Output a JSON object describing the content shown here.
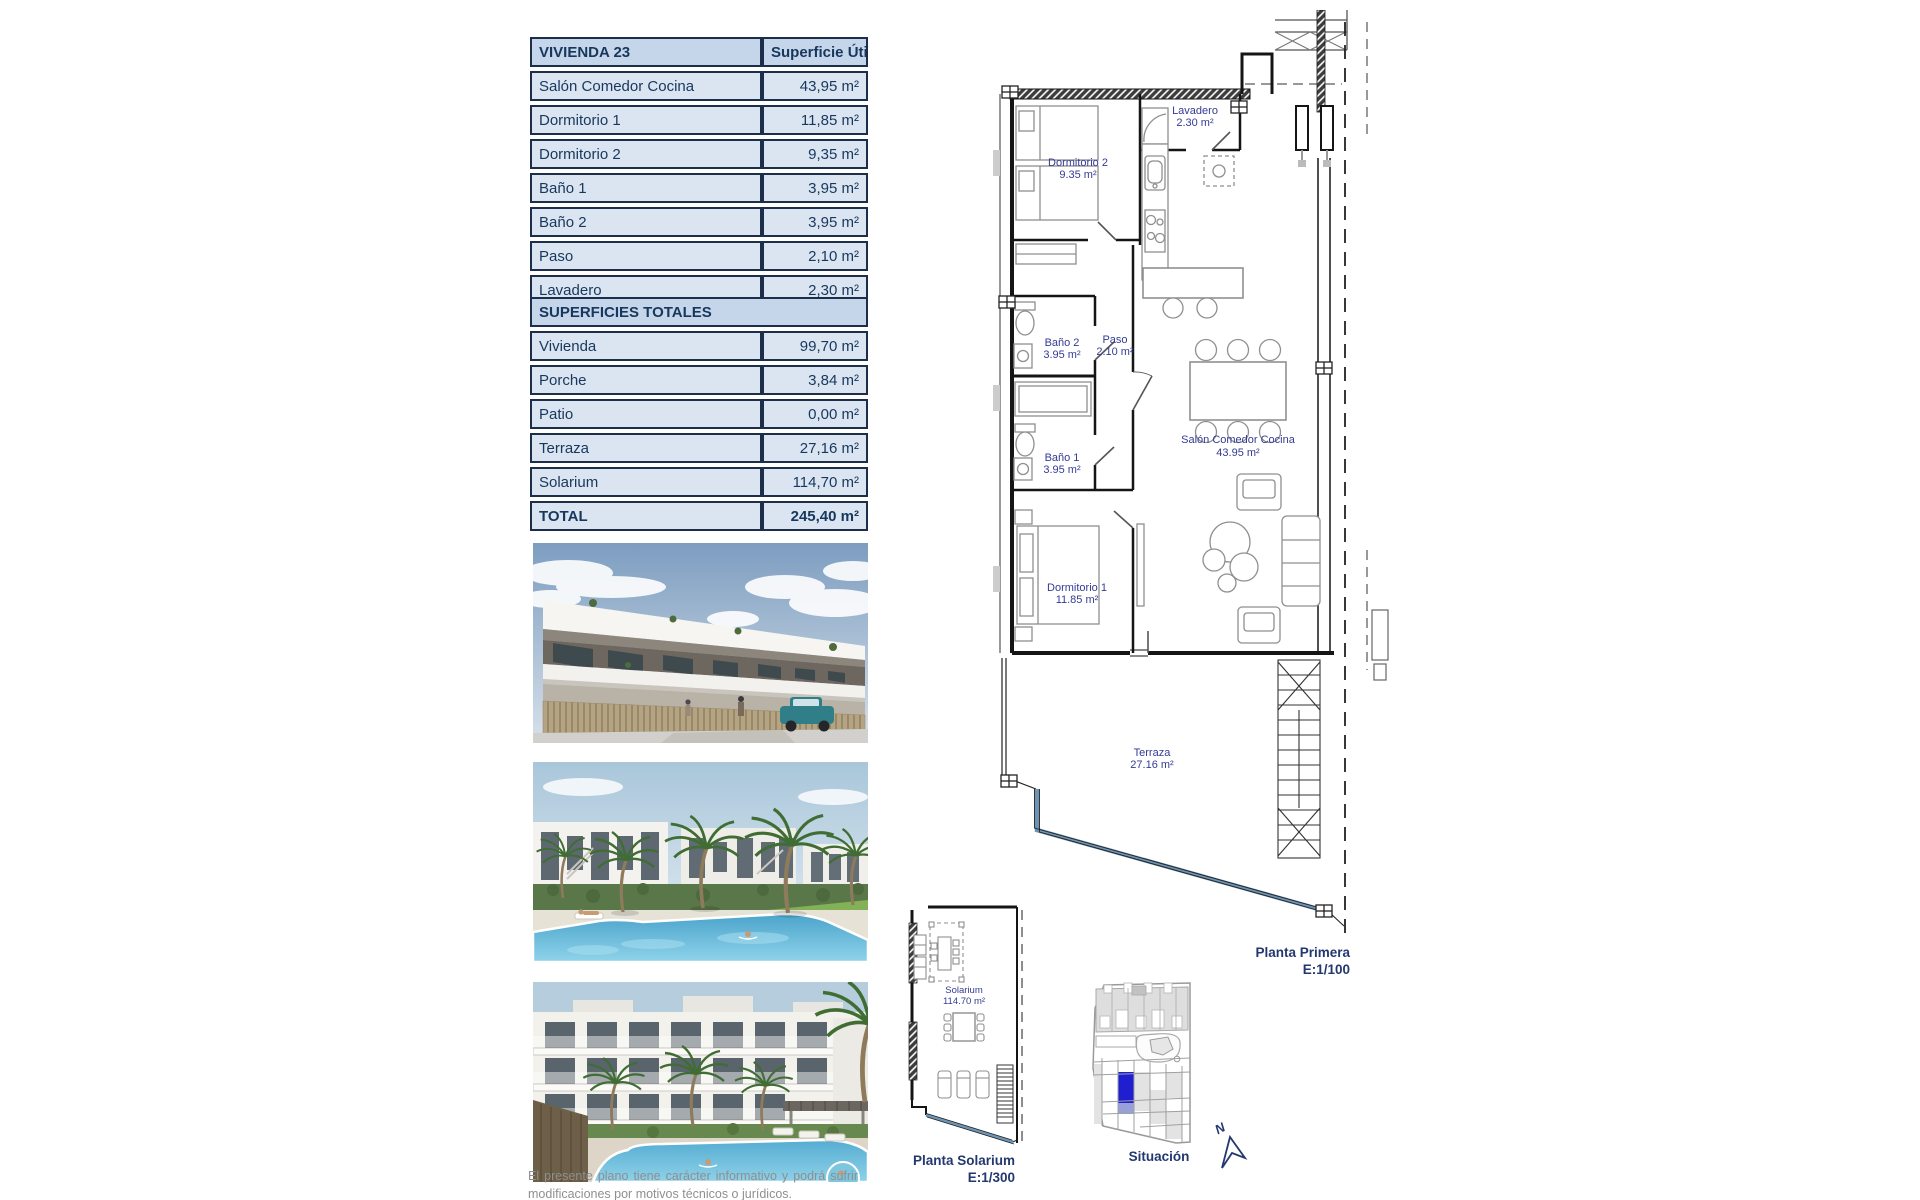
{
  "document": {
    "tables": {
      "vivienda": {
        "title": "VIVIENDA 23",
        "value_header": "Superficie Útil",
        "rows": [
          {
            "label": "Salón Comedor Cocina",
            "value": "43,95 m²"
          },
          {
            "label": "Dormitorio 1",
            "value": "11,85 m²"
          },
          {
            "label": "Dormitorio 2",
            "value": "9,35 m²"
          },
          {
            "label": "Baño 1",
            "value": "3,95 m²"
          },
          {
            "label": "Baño 2",
            "value": "3,95 m²"
          },
          {
            "label": "Paso",
            "value": "2,10 m²"
          },
          {
            "label": "Lavadero",
            "value": "2,30 m²"
          }
        ]
      },
      "totales": {
        "title": "SUPERFICIES TOTALES",
        "rows": [
          {
            "label": "Vivienda",
            "value": "99,70 m²"
          },
          {
            "label": "Porche",
            "value": "3,84 m²"
          },
          {
            "label": "Patio",
            "value": "0,00 m²"
          },
          {
            "label": "Terraza",
            "value": "27,16 m²"
          },
          {
            "label": "Solarium",
            "value": "114,70 m²"
          }
        ],
        "total_row": {
          "label": "TOTAL",
          "value": "245,40 m²"
        }
      }
    },
    "floorplan": {
      "rooms": [
        {
          "name": "Lavadero",
          "area": "2.30 m²"
        },
        {
          "name": "Dormitorio 2",
          "area": "9.35 m²"
        },
        {
          "name": "Baño 2",
          "area": "3.95 m²"
        },
        {
          "name": "Paso",
          "area": "2.10 m²"
        },
        {
          "name": "Baño 1",
          "area": "3.95 m²"
        },
        {
          "name": "Salón Comedor Cocina",
          "area": "43.95 m²"
        },
        {
          "name": "Dormitorio 1",
          "area": "11.85 m²"
        },
        {
          "name": "Terraza",
          "area": "27.16 m²"
        }
      ],
      "caption": {
        "title": "Planta Primera",
        "scale": "E:1/100"
      }
    },
    "solarium_plan": {
      "room": {
        "name": "Solarium",
        "area": "114.70 m²"
      },
      "caption": {
        "title": "Planta Solarium",
        "scale": "E:1/300"
      }
    },
    "situation_plan": {
      "caption": "Situación",
      "north_label": "N"
    },
    "disclaimer": "El presente plano tiene carácter informativo y podrá sufrir modificaciones por motivos técnicos o jurídicos.",
    "colors": {
      "table_header_bg": "#c6d6ea",
      "table_row_bg": "#dbe5f1",
      "table_border": "#1c2e4a",
      "table_text": "#17375d",
      "plan_label": "#343b94",
      "caption_text": "#22386e",
      "terrace_line_blue": "#6d94b5",
      "site_highlight_blue": "#1f1fd0",
      "site_highlight_light": "#98a0da",
      "disclaimer_text": "#8f8f8f"
    }
  }
}
